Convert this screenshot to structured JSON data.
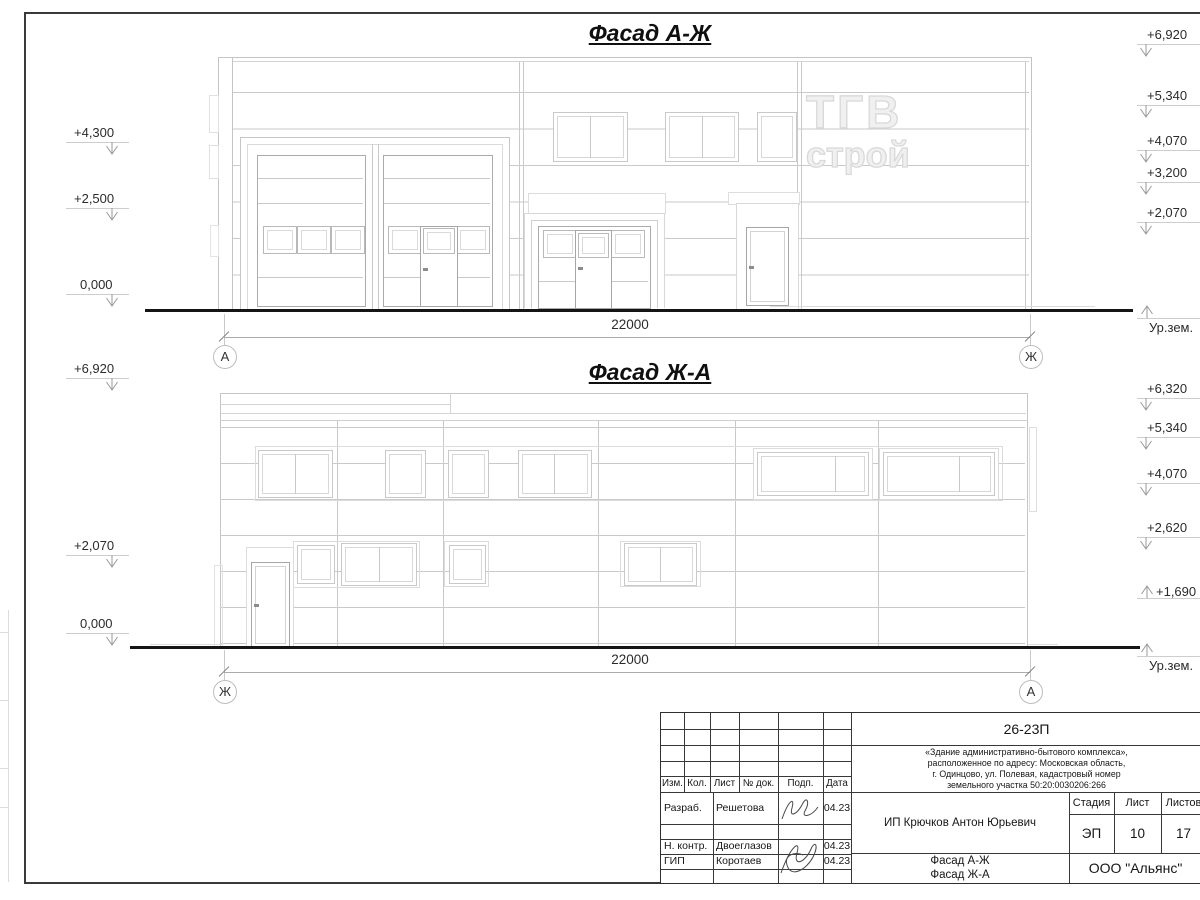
{
  "facades": {
    "top": {
      "title": "Фасад А-Ж",
      "dim": "22000",
      "axis_left": "А",
      "axis_right": "Ж",
      "ground_label": "Ур.зем.",
      "marks_left": [
        "+4,300",
        "+2,500",
        "0,000"
      ],
      "marks_right": [
        "+6,920",
        "+5,340",
        "+4,070",
        "+3,200",
        "+2,070"
      ]
    },
    "bottom": {
      "title": "Фасад Ж-А",
      "dim": "22000",
      "axis_left": "Ж",
      "axis_right": "А",
      "ground_label": "Ур.зем.",
      "marks_left": [
        "+6,920",
        "+2,070",
        "0,000"
      ],
      "marks_right": [
        "+6,320",
        "+5,340",
        "+4,070",
        "+2,620",
        "+1,690"
      ]
    }
  },
  "watermark": {
    "line1": "ТГВ",
    "line2": "строй"
  },
  "title_block": {
    "code": "26-23П",
    "object_lines": [
      "«Здание административно-бытового комплекса»,",
      "расположенное по адресу: Московская область,",
      "г. Одинцово, ул. Полевая, кадастровый номер",
      "земельного участка 50:20:0030206:266"
    ],
    "cols": {
      "izm": "Изм.",
      "kol": "Кол.",
      "list": "Лист",
      "doc": "№ док.",
      "podp": "Подп.",
      "data": "Дата"
    },
    "rows": [
      {
        "role": "Разраб.",
        "name": "Решетова",
        "date": "04.23"
      },
      {
        "role": "Н. контр.",
        "name": "Двоеглазов",
        "date": "04.23"
      },
      {
        "role": "ГИП",
        "name": "Коротаев",
        "date": "04.23"
      }
    ],
    "client": "ИП Крючков Антон Юрьевич",
    "stage_label": "Стадия",
    "sheet_label": "Лист",
    "sheets_label": "Листов",
    "stage": "ЭП",
    "sheet_num": "10",
    "sheets_total": "17",
    "sheet_name_1": "Фасад А-Ж",
    "sheet_name_2": "Фасад Ж-А",
    "company": "ООО \"Альянс\""
  }
}
